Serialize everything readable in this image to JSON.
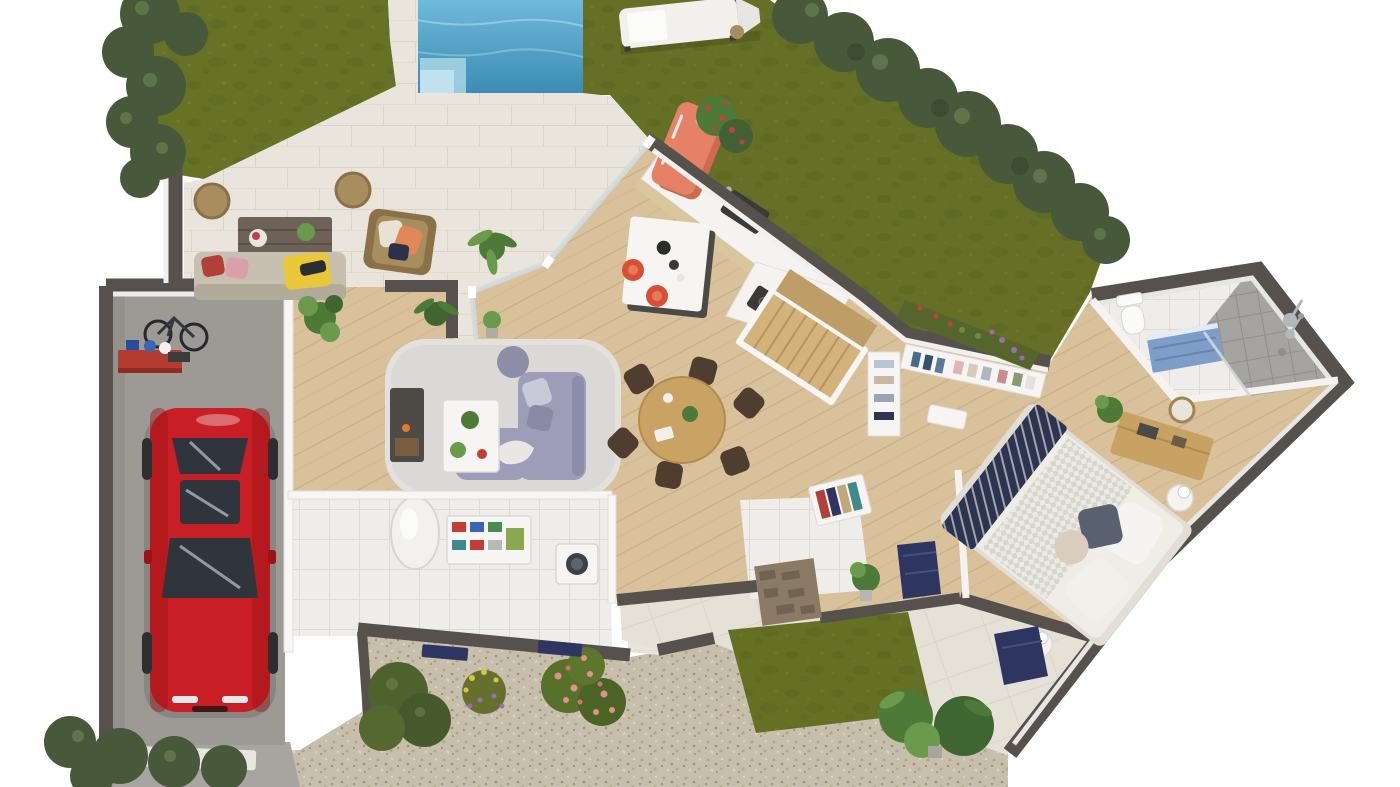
{
  "scene": {
    "title": "3D rendered ground-floor plan with garden, swimming pool, patio, garage and red car",
    "view": "top-down 3D architectural render, house wing rotated diagonally",
    "background": "#ffffff"
  },
  "colors": {
    "lawn": "#687226",
    "lawnDark": "#576320",
    "lawnLight": "#7c8733",
    "lawnTerrace": "#66702a",
    "hedge": "#47583b",
    "hedgeDark": "#394b2f",
    "hedgeLight": "#69824f",
    "water": "#6fb9da",
    "waterDeep": "#3c8cb4",
    "poolStep": "#a9d6e6",
    "pavement": "#e9e5dc",
    "pavementLine": "#dbd5c8",
    "terraceTile": "#e6e1d7",
    "gravel": "#c8beac",
    "gravelDot1": "#b2a58e",
    "gravelDot2": "#a08f79",
    "gravelDot3": "#d9d1c3",
    "concrete": "#9d9a96",
    "concreteDark": "#8c8985",
    "apron": "#a8a5a0",
    "wallCap": "#56514d",
    "wallFace": "#f2f1ef",
    "wallWhite": "#f7f6f4",
    "glass": "#ccd7d8",
    "wood": "#d9c29b",
    "woodLine": "#c8ad82",
    "stairWood": "#d3b27c",
    "stairWoodDark": "#bf9d66",
    "tileWhite": "#efedea",
    "tileLine": "#dedbd5",
    "showerTile": "#a5a4a1",
    "showerLine": "#918f8d",
    "fridge": "#e58167",
    "fridgeDark": "#cf6950",
    "island": "#f6f5f3",
    "islandBase": "#4b4a48",
    "counterTop": "#f4f3f1",
    "counterWood": "#d9c69d",
    "applianceDark": "#3b3a38",
    "stoolRed": "#d94f35",
    "tableWood": "#c9a364",
    "chairBrown": "#4f3e2f",
    "sofaLavender": "#9d9dba",
    "sofaLavenderDark": "#8c8cab",
    "rug": "#dbd9d5",
    "pouf": "#8e8ea8",
    "whiteFurniture": "#f6f5f3",
    "plantGreen": "#4e7a38",
    "plantLight": "#6a9a4c",
    "outdoorSofa": "#c7c0b1",
    "outdoorSofaDark": "#b3ab9a",
    "pillowRed": "#b04038",
    "throwYellow": "#e8c838",
    "wicker": "#a88e5e",
    "wickerDark": "#8a7148",
    "woodOutdoor": "#6e6258",
    "carRed": "#c81f26",
    "carRedDark": "#9c1117",
    "carGlass": "#30343c",
    "carGlassLight": "#aab4bd",
    "bedFrame": "#e2ded6",
    "duvet": "#f0ede7",
    "sheetCheck": "#d8d5cc",
    "bedNavy": "#2d3450",
    "pillowDark": "#596070",
    "pillowBeige": "#d9cebd",
    "nightstand": "#f5f4f2",
    "dresserWood": "#c8a263",
    "vanityBlue": "#7e9dc8",
    "toiletWhite": "#fafaf9",
    "chrome": "#b4b7b9",
    "doorNavy": "#2e3560",
    "stone": "#8a7a66",
    "stoneDark": "#6c5e4c",
    "heater": "#f2f1ee",
    "boxRed": "#c43c34",
    "boxBlue": "#3a66b0",
    "boxGreen": "#4e8a50",
    "boxTeal": "#3f8a8a",
    "flowerPink": "#e2908e",
    "flowerRed": "#c14040",
    "flowerPurple": "#9a6cb8",
    "flowerYellow": "#d6c83e",
    "flowerRose": "#d4706a"
  },
  "rooms": [
    {
      "id": "garden",
      "name": "Garden with lawns, hedges and swimming pool"
    },
    {
      "id": "patio",
      "name": "Paved patio terrace"
    },
    {
      "id": "garage",
      "name": "Garage"
    },
    {
      "id": "utility",
      "name": "Utility / laundry room"
    },
    {
      "id": "living",
      "name": "Living room"
    },
    {
      "id": "kitchen",
      "name": "Open kitchen"
    },
    {
      "id": "dining",
      "name": "Dining area"
    },
    {
      "id": "hallway",
      "name": "Entry hallway"
    },
    {
      "id": "closet",
      "name": "Walk-in closet"
    },
    {
      "id": "bedroom",
      "name": "Bedroom"
    },
    {
      "id": "bathroom",
      "name": "Bathroom with walk-in shower"
    },
    {
      "id": "terrace",
      "name": "Front terrace and gravel driveway"
    }
  ],
  "furniture": {
    "garden": [
      "swimming pool with corner steps",
      "double sun lounger",
      "hedge rows",
      "rose and lavender flower beds",
      "monstera plants",
      "gravel driveway",
      "small lawn patch"
    ],
    "patio": [
      "outdoor sofa with yellow throw",
      "rattan armchair with pillows",
      "wooden coffee table",
      "two rattan poufs",
      "potted palms"
    ],
    "garage": [
      "red sports car",
      "wall-mounted bicycle",
      "red workbench with storage boxes"
    ],
    "utility": [
      "water heater cylinder",
      "shelving with colored boxes",
      "washing machine",
      "navy window shutters"
    ],
    "living": [
      "lavender corner sofa",
      "white coffee table with plants",
      "gray shaggy rug",
      "purple pouf",
      "dark media / fireplace unit"
    ],
    "kitchen": [
      "coral retro fridge",
      "counter with dark sink",
      "counter with cooktop",
      "white island with dark base",
      "two red bar stools",
      "wooden staircase"
    ],
    "dining": [
      "round wooden table",
      "six dark wooden chairs"
    ],
    "hallway": [
      "coat rack with jackets",
      "navy front door",
      "stone-clad porch wall",
      "entry tiles"
    ],
    "closet": [
      "white shelving with folded clothes",
      "hanging rail with jeans",
      "shoe cubbies"
    ],
    "bedroom": [
      "double bed with navy throw and pillows",
      "round nightstands with lamps",
      "wooden sideboard",
      "round mirror",
      "potted plant",
      "navy terrace mat"
    ],
    "bathroom": [
      "toilet",
      "blue vanity unit",
      "walk-in shower with gray tiles",
      "chrome shower fixture"
    ]
  }
}
